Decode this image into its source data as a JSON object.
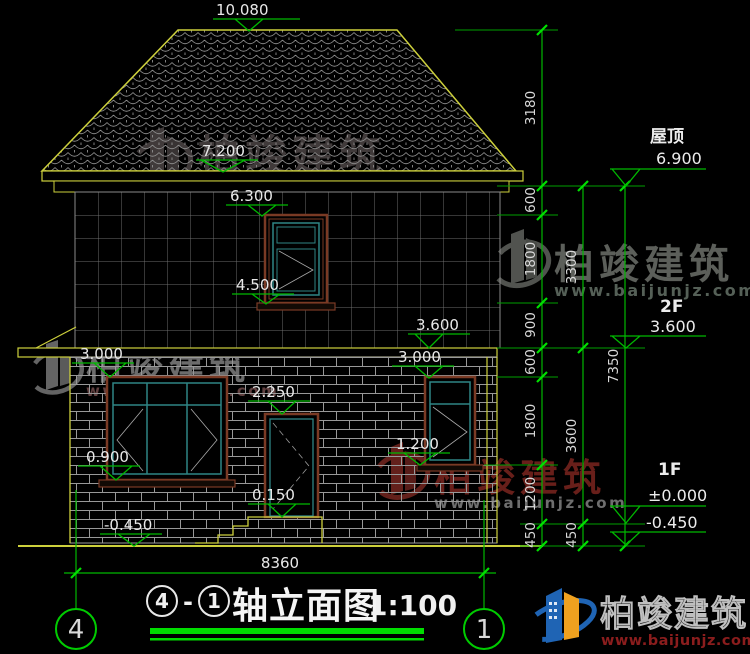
{
  "levels": {
    "l10080": "10.080",
    "l7200": "7.200",
    "l6300": "6.300",
    "l4500": "4.500",
    "l3600": "3.600",
    "l3000_left": "3.000",
    "l3000_right": "3.000",
    "l2250": "2.250",
    "l1200": "1.200",
    "l0900": "0.900",
    "l0150": "0.150",
    "lm0450_left": "-0.450"
  },
  "marks": {
    "roof_label": "屋顶",
    "roof_value": "6.900",
    "f2_label": "2F",
    "f2_value": "3.600",
    "f1_label": "1F",
    "f1_value": "±0.000",
    "basement_value": "-0.450"
  },
  "chains": {
    "inner": [
      "3180",
      "600",
      "1800",
      "900",
      "600",
      "1800",
      "1200",
      "450"
    ],
    "mid": [
      "3300",
      "3600",
      "450"
    ],
    "total": "7350"
  },
  "bottom": {
    "overall": "8360",
    "axis_left": "4",
    "axis_right": "1"
  },
  "title": {
    "bubble_left": "4",
    "separator": "-",
    "bubble_right": "1",
    "name": "轴立面图",
    "scale": "1:100"
  },
  "brand": {
    "name": "柏竣建筑",
    "url": "www.baijunjz.com"
  },
  "colors": {
    "line_green": "#00b800",
    "bright_green": "#00dd00",
    "outline_yellow": "#cdd03c",
    "frame_brown": "#7a3a24",
    "frame_teal": "#2f8585",
    "text_white": "#e8e8e8",
    "logo_blue": "#1f64b4",
    "logo_orange": "#efa11f",
    "url_red": "#8b1d1d"
  }
}
